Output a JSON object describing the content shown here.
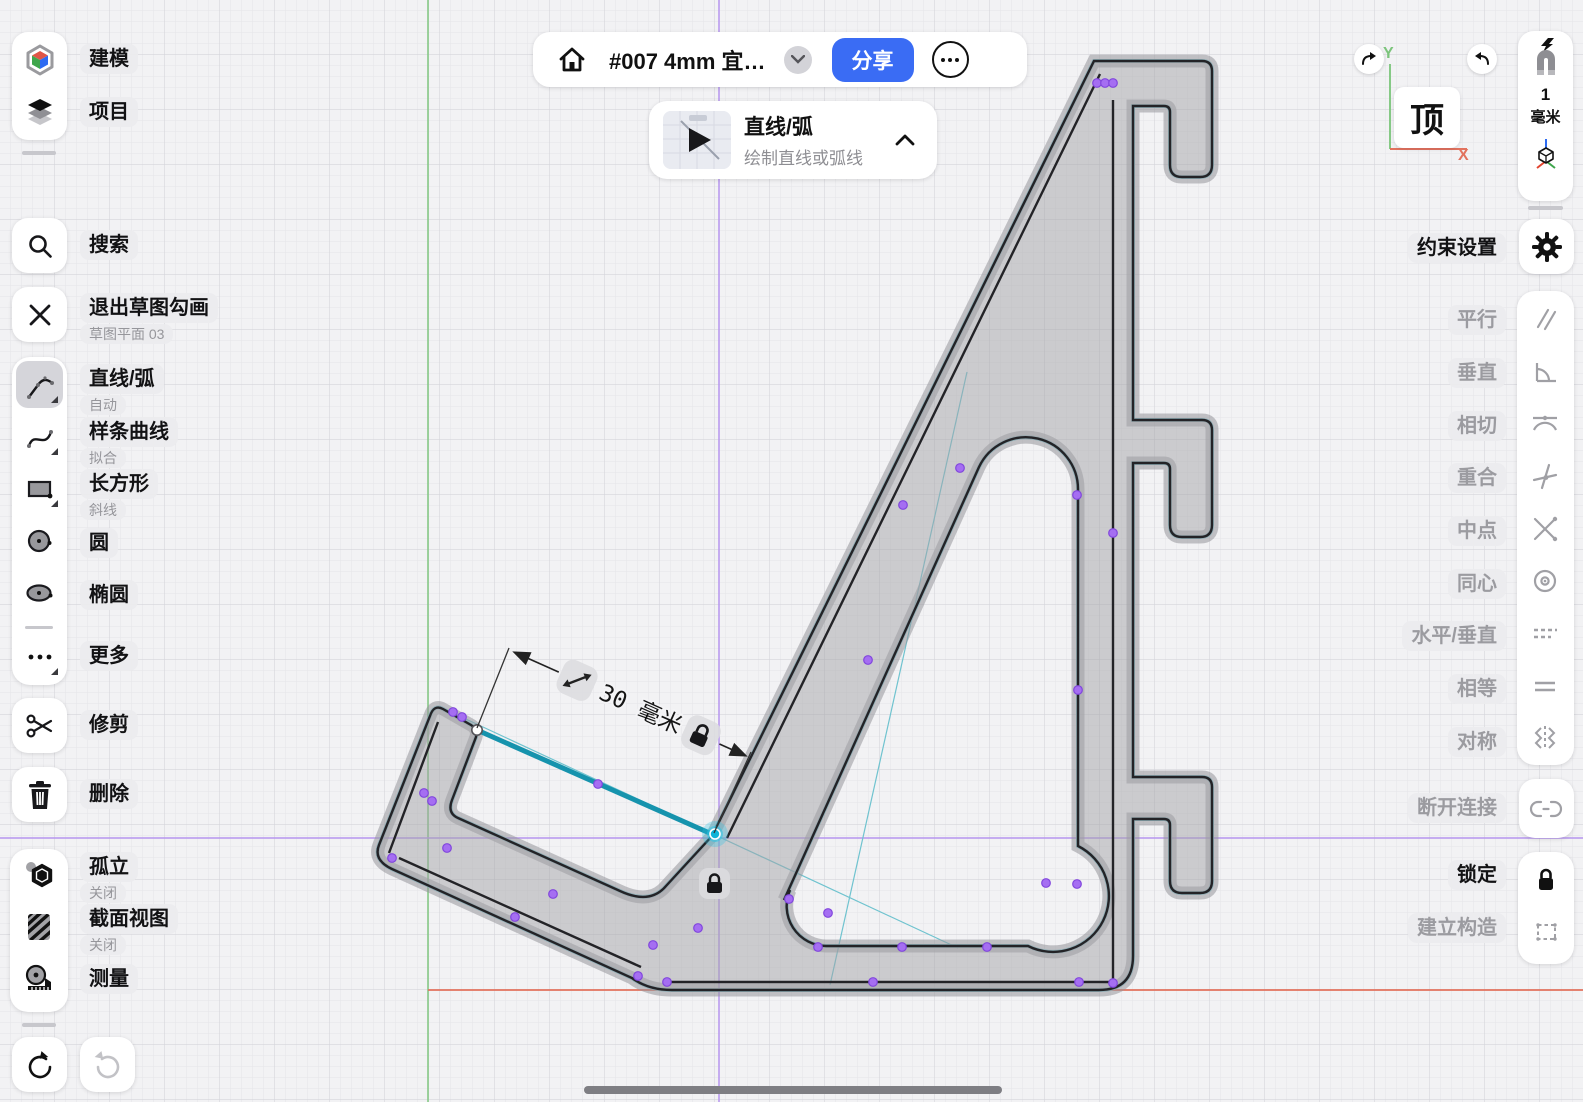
{
  "top_bar": {
    "title": "#007  4mm 宜…",
    "share": "分享"
  },
  "tool_hint": {
    "title": "直线/弧",
    "subtitle": "绘制直线或弧线"
  },
  "sidebar": {
    "modeling": "建模",
    "projects": "项目",
    "search": "搜索",
    "exit_title": "退出草图勾画",
    "exit_sub": "草图平面 03",
    "tools": [
      {
        "label": "直线/弧",
        "sub": "自动"
      },
      {
        "label": "样条曲线",
        "sub": "拟合"
      },
      {
        "label": "长方形",
        "sub": "斜线"
      },
      {
        "label": "圆"
      },
      {
        "label": "椭圆"
      },
      {
        "label": "更多"
      }
    ],
    "trim": "修剪",
    "delete": "删除",
    "isolate": "孤立",
    "isolate_sub": "关闭",
    "section": "截面视图",
    "section_sub": "关闭",
    "measure": "测量"
  },
  "right_panel": {
    "constraint_settings": "约束设置",
    "constraints": [
      "平行",
      "垂直",
      "相切",
      "重合",
      "中点",
      "同心",
      "水平/垂直",
      "相等",
      "对称"
    ],
    "disconnect": "断开连接",
    "lock": "锁定",
    "construction": "建立构造",
    "grid_value": "1",
    "grid_unit": "毫米"
  },
  "gizmo": {
    "view": "顶",
    "axis_y": "Y",
    "axis_x": "X"
  },
  "canvas": {
    "dimension": "30 毫米"
  },
  "colors": {
    "accent_blue": "#3a6cf4",
    "select_teal": "#1693ad",
    "constraint_purple": "#a56ef2",
    "axis_red": "#e2725e",
    "axis_green": "#86c986",
    "sketch_axis_purple": "#b695ef"
  }
}
